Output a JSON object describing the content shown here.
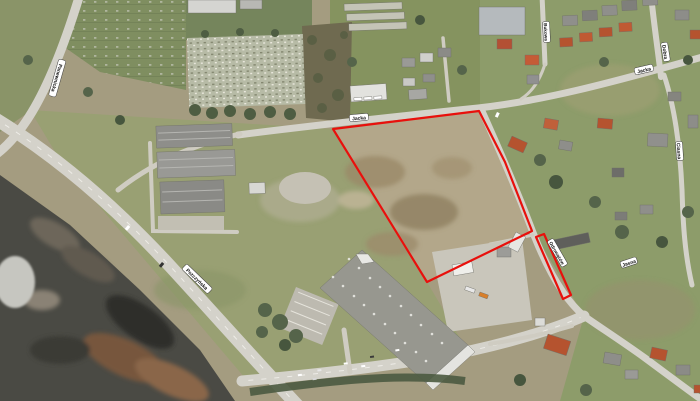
{
  "map": {
    "kind": "aerial orthophoto with red-outlined land parcel",
    "parcel": {
      "outline_color": "#e8100c",
      "main_points": "333,129 479,111 505,162 532,231 427,282",
      "strip_points": "536,237 544,234 571,295 563,299"
    },
    "street_labels": [
      {
        "text": "Panewnicka"
      },
      {
        "text": "Pszczyńska"
      },
      {
        "text": "Jacka"
      },
      {
        "text": "Jacka"
      },
      {
        "text": "Dobra"
      },
      {
        "text": "Ciasna"
      },
      {
        "text": "Odrowążów"
      },
      {
        "text": "Jasna"
      },
      {
        "text": "Bukowa"
      }
    ],
    "colors": {
      "terrain_base": "#a49c80",
      "grassland": "#99a073",
      "residential_green": "#8d9c6a",
      "parcel_field": "#b3a78a",
      "spoil_dark": "#4a4a44",
      "road": "#d4d2ca",
      "building_gray": "#97978f",
      "roof_red": "#b5532f",
      "label_background": "#ffffff",
      "label_text": "#111111"
    }
  }
}
